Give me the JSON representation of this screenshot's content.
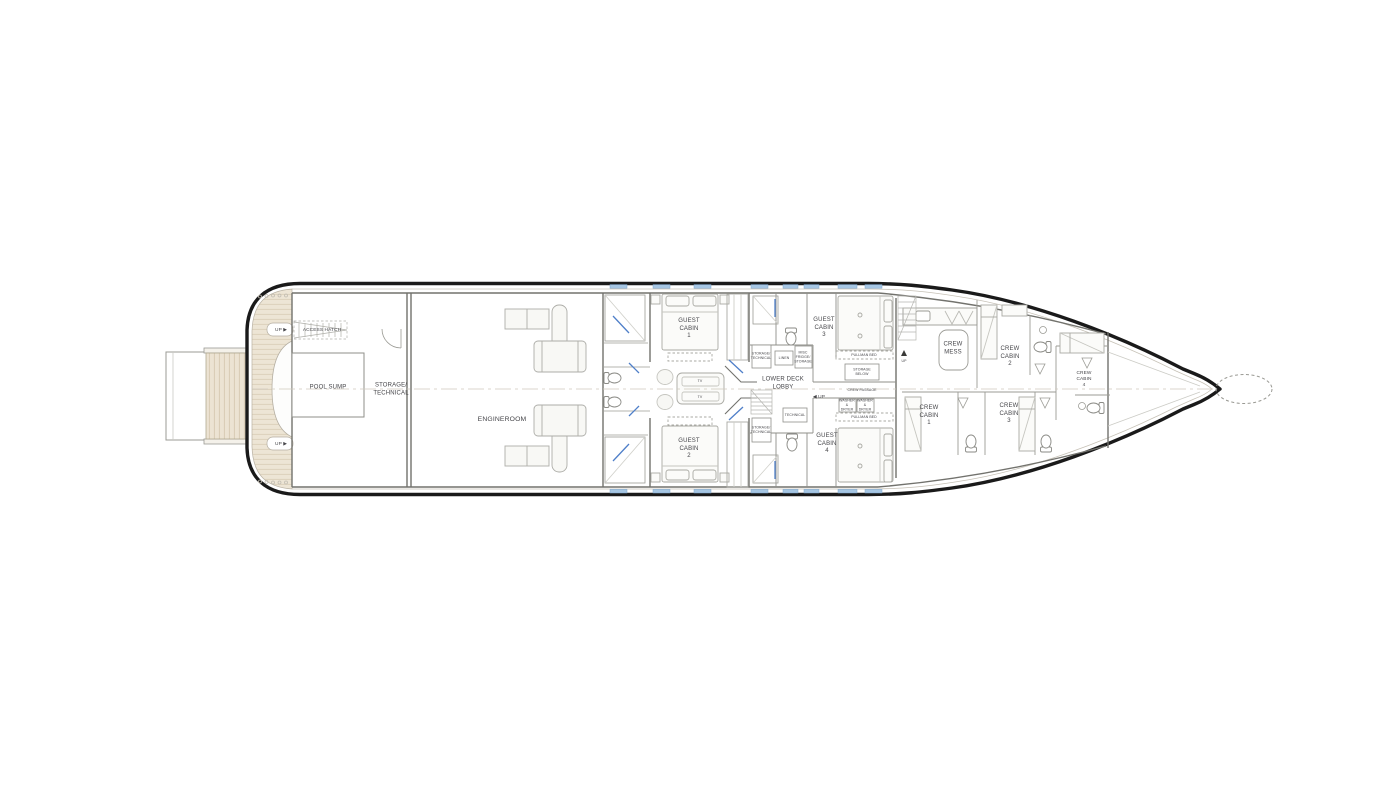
{
  "rooms": {
    "pool_sump": "POOL SUMP",
    "storage_technical": "STORAGE/\nTECHNICAL",
    "engineroom": "ENGINEROOM",
    "guest_cabin_1": "GUEST\nCABIN\n1",
    "guest_cabin_2": "GUEST\nCABIN\n2",
    "guest_cabin_3": "GUEST\nCABIN\n3",
    "guest_cabin_4": "GUEST\nCABIN\n4",
    "lower_deck_lobby": "LOWER DECK\nLOBBY",
    "crew_mess": "CREW\nMESS",
    "crew_cabin_1": "CREW\nCABIN\n1",
    "crew_cabin_2": "CREW\nCABIN\n2",
    "crew_cabin_3": "CREW\nCABIN\n3",
    "crew_cabin_4": "CREW\nCABIN\n4"
  },
  "features": {
    "access_hatch": "ACCESS HATCH",
    "up_aft": "UP ▶",
    "up_lobby": "◀ UP",
    "up_crew": "UP",
    "tv": "TV",
    "storage_technical_small": "STORAGE/\nTECHNICAL",
    "linen": "LINEN",
    "misc_fridge_storage": "MISC\nFRIDGE/\nSTORAGE",
    "technical": "TECHNICAL",
    "storage_below": "STORAGE\nBELOW",
    "crew_passage": "CREW PASSAGE",
    "pullman_bed": "PULLMAN BED",
    "washer_dryer": "WASHER\n&\nDRYER"
  },
  "colors": {
    "hull_outline": "#1a1a1a",
    "interior_line": "#9b9b95",
    "bulkhead": "#72726d",
    "teak_deck": "#ede5d5",
    "teak_stripe": "#dcd1bc",
    "window_blue": "#a6c6e3",
    "door_glass_blue": "#4f7fc9",
    "label_text": "#46464a",
    "furniture_fill": "#fafaf7"
  }
}
